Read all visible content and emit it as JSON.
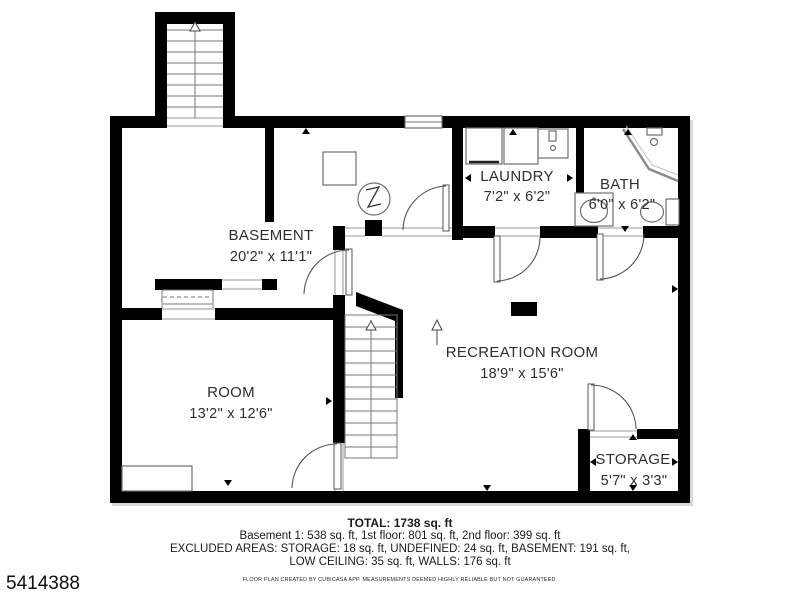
{
  "document": {
    "id_number": "5414388"
  },
  "floorplan": {
    "rooms": {
      "basement": {
        "label": "BASEMENT",
        "dims": "20'2\" x 11'1\""
      },
      "laundry": {
        "label": "LAUNDRY",
        "dims": "7'2\" x 6'2\""
      },
      "bath": {
        "label": "BATH",
        "dims": "6'0\" x 6'2\""
      },
      "recreation": {
        "label": "RECREATION ROOM",
        "dims": "18'9\" x 15'6\""
      },
      "room": {
        "label": "ROOM",
        "dims": "13'2\" x 12'6\""
      },
      "storage": {
        "label": "STORAGE",
        "dims": "5'7\" x 3'3\""
      }
    },
    "icons": [
      "exterior-stairs-up-icon",
      "interior-stairs-up-icon",
      "direction-arrow-icon",
      "water-heater-icon",
      "furnace-icon",
      "washer-icon",
      "dryer-icon",
      "laundry-sink-icon",
      "corner-shower-icon",
      "bathroom-sink-icon",
      "toilet-icon",
      "closet-rod-icon",
      "counter-icon",
      "support-column",
      "window-icon",
      "door-swing-icon"
    ],
    "colors": {
      "walls": "#000000",
      "fixtures": "#6e6e6e",
      "labels": "#2e2e2e"
    }
  },
  "summary": {
    "total": "TOTAL: 1738 sq. ft",
    "floors": "Basement 1: 538 sq. ft, 1st floor: 801 sq. ft, 2nd floor: 399 sq. ft",
    "excluded_1": "EXCLUDED AREAS: STORAGE: 18 sq. ft, UNDEFINED: 24 sq. ft, BASEMENT: 191 sq. ft,",
    "excluded_2": "LOW CEILING: 35 sq. ft, WALLS: 176 sq. ft",
    "disclaimer": "FLOOR PLAN CREATED BY CUBICASA APP. MEASUREMENTS DEEMED HIGHLY RELIABLE BUT NOT GUARANTEED."
  }
}
